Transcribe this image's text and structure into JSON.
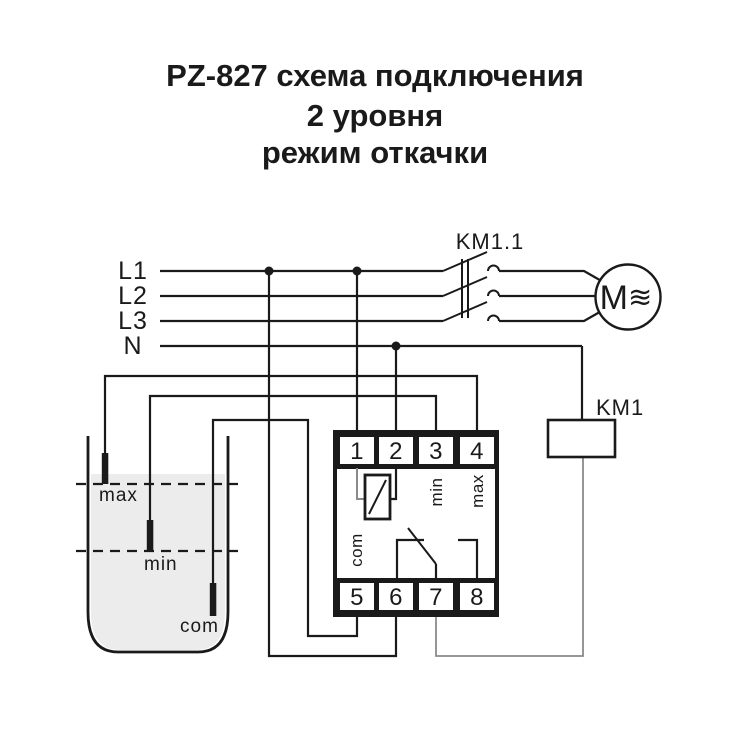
{
  "title": {
    "line1": "PZ-827 схема подключения",
    "line2": "2 уровня",
    "line3": "режим откачки"
  },
  "power": {
    "l1": "L1",
    "l2": "L2",
    "l3": "L3",
    "n": "N"
  },
  "contactor": {
    "label": "KM1.1"
  },
  "motor": {
    "m_label": "M",
    "wave_icon": "≋"
  },
  "coil": {
    "label": "KM1"
  },
  "tank": {
    "max_label": "max",
    "min_label": "min",
    "com_label": "com"
  },
  "relay": {
    "terminals_top": [
      "1",
      "2",
      "3",
      "4"
    ],
    "terminals_bottom": [
      "5",
      "6",
      "7",
      "8"
    ],
    "labels": {
      "min": "min",
      "max": "max",
      "com": "com"
    }
  },
  "colors": {
    "line": "#1a1a1a",
    "gray_wire": "#8a8a8a",
    "water": "#ececec",
    "background": "#ffffff"
  }
}
